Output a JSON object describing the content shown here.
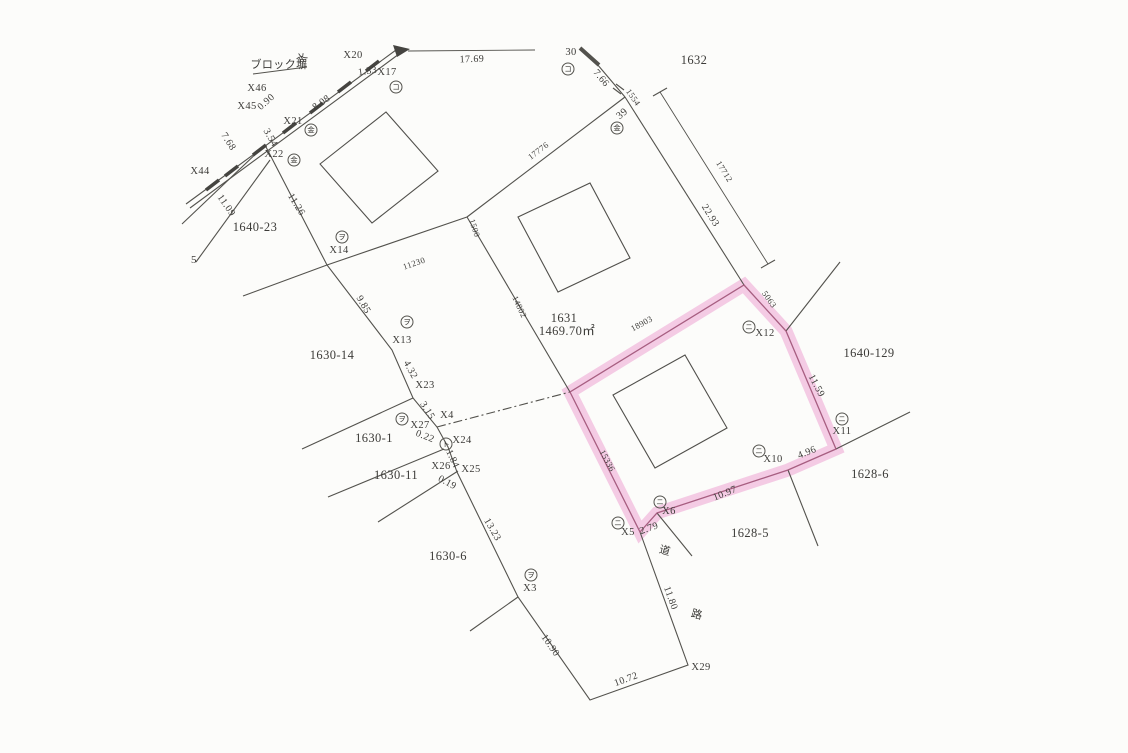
{
  "map": {
    "type": "cadastral-survey-map",
    "colors": {
      "paper": "#fcfcfa",
      "ink": "#3c3b38",
      "line": "#53524d",
      "red": "#c04a5e",
      "pink_band": "#eda2d2",
      "pink_edge": "#9e5276"
    },
    "highlighted_parcel": {
      "adjacent_note": "parcel outlined in pink between 1631 and 1628-5",
      "edge_lengths_mm": [
        "18903",
        "5063",
        "15336"
      ],
      "edge_lengths_m": [
        "11.59",
        "4.96",
        "10.97",
        "2.79"
      ]
    },
    "parcel_labels": [
      {
        "text": "1632",
        "x": 694,
        "y": 64,
        "size": 13
      },
      {
        "text": "1640-23",
        "x": 255,
        "y": 231
      },
      {
        "text": "1630-14",
        "x": 332,
        "y": 359
      },
      {
        "text": "1630-1",
        "x": 374,
        "y": 442
      },
      {
        "text": "1630-11",
        "x": 396,
        "y": 479
      },
      {
        "text": "1630-6",
        "x": 448,
        "y": 560
      },
      {
        "text": "1628-5",
        "x": 750,
        "y": 537
      },
      {
        "text": "1628-6",
        "x": 870,
        "y": 478
      },
      {
        "text": "1640-129",
        "x": 869,
        "y": 357
      },
      {
        "text": "1631",
        "x": 564,
        "y": 322,
        "size": 13
      },
      {
        "text": "1469.70㎡",
        "x": 567,
        "y": 335,
        "size": 10.5
      }
    ],
    "point_labels": [
      {
        "text": "X46",
        "x": 257,
        "y": 91
      },
      {
        "text": "X45",
        "x": 247,
        "y": 109
      },
      {
        "text": "X44",
        "x": 200,
        "y": 174
      },
      {
        "text": "X20",
        "x": 353,
        "y": 58
      },
      {
        "text": "X17",
        "x": 387,
        "y": 75
      },
      {
        "text": "X21",
        "x": 293,
        "y": 124
      },
      {
        "text": "X22",
        "x": 274,
        "y": 157
      },
      {
        "text": "X14",
        "x": 339,
        "y": 253
      },
      {
        "text": "X13",
        "x": 402,
        "y": 343
      },
      {
        "text": "X23",
        "x": 425,
        "y": 388
      },
      {
        "text": "X4",
        "x": 447,
        "y": 418
      },
      {
        "text": "X27",
        "x": 420,
        "y": 428
      },
      {
        "text": "X24",
        "x": 462,
        "y": 443
      },
      {
        "text": "X26",
        "x": 441,
        "y": 469
      },
      {
        "text": "X25",
        "x": 471,
        "y": 472
      },
      {
        "text": "X3",
        "x": 530,
        "y": 591
      },
      {
        "text": "X29",
        "x": 701,
        "y": 670
      },
      {
        "text": "X5",
        "x": 628,
        "y": 535
      },
      {
        "text": "X6",
        "x": 669,
        "y": 514,
        "color": "red"
      },
      {
        "text": "X10",
        "x": 773,
        "y": 462,
        "color": "red"
      },
      {
        "text": "X11",
        "x": 842,
        "y": 434
      },
      {
        "text": "X12",
        "x": 765,
        "y": 336,
        "color": "red"
      },
      {
        "text": "30",
        "x": 571,
        "y": 55
      },
      {
        "text": "39",
        "x": 624,
        "y": 116,
        "rot": -40
      }
    ],
    "measurements": [
      {
        "text": "17.69",
        "x": 472,
        "y": 62,
        "rot": -2
      },
      {
        "text": "1.33",
        "x": 368,
        "y": 74,
        "rot": -8
      },
      {
        "text": "0.90",
        "x": 268,
        "y": 104,
        "rot": -42
      },
      {
        "text": "8.08",
        "x": 323,
        "y": 105,
        "rot": -35
      },
      {
        "text": "7.68",
        "x": 226,
        "y": 143,
        "rot": 58
      },
      {
        "text": "3.54",
        "x": 268,
        "y": 139,
        "rot": 60
      },
      {
        "text": "11.09",
        "x": 224,
        "y": 207,
        "rot": 55
      },
      {
        "text": "11.26",
        "x": 294,
        "y": 206,
        "rot": 58
      },
      {
        "text": "9.85",
        "x": 361,
        "y": 306,
        "rot": 60
      },
      {
        "text": "4.32",
        "x": 408,
        "y": 371,
        "rot": 62
      },
      {
        "text": "3.15",
        "x": 425,
        "y": 412,
        "rot": 58
      },
      {
        "text": "0.22",
        "x": 424,
        "y": 439,
        "rot": 22
      },
      {
        "text": "1.84",
        "x": 450,
        "y": 460,
        "rot": 65
      },
      {
        "text": "0.19",
        "x": 446,
        "y": 485,
        "rot": 28
      },
      {
        "text": "13.23",
        "x": 490,
        "y": 531,
        "rot": 60
      },
      {
        "text": "10.90",
        "x": 548,
        "y": 647,
        "rot": 55
      },
      {
        "text": "10.72",
        "x": 627,
        "y": 682,
        "rot": -20
      },
      {
        "text": "11.80",
        "x": 668,
        "y": 599,
        "rot": 70
      },
      {
        "text": "7.66",
        "x": 599,
        "y": 80,
        "rot": 50
      },
      {
        "text": "22.93",
        "x": 708,
        "y": 217,
        "rot": 58
      },
      {
        "text": "11.59",
        "x": 814,
        "y": 387,
        "rot": 62
      },
      {
        "text": "4.96",
        "x": 808,
        "y": 455,
        "rot": -22,
        "color": "red"
      },
      {
        "text": "10.97",
        "x": 726,
        "y": 496,
        "rot": -22,
        "color": "red"
      },
      {
        "text": "2.79",
        "x": 650,
        "y": 531,
        "rot": -20,
        "color": "red"
      }
    ],
    "mm_values": [
      {
        "text": "17776",
        "x": 540,
        "y": 153,
        "rot": -37
      },
      {
        "text": "1500",
        "x": 472,
        "y": 229,
        "rot": 72
      },
      {
        "text": "14802",
        "x": 517,
        "y": 308,
        "rot": 65
      },
      {
        "text": "11230",
        "x": 415,
        "y": 266,
        "rot": -19
      },
      {
        "text": "1554",
        "x": 631,
        "y": 99,
        "rot": 55
      },
      {
        "text": "17712",
        "x": 722,
        "y": 173,
        "rot": 58
      },
      {
        "text": "5063",
        "x": 767,
        "y": 301,
        "rot": 55
      },
      {
        "text": "18903",
        "x": 643,
        "y": 326,
        "rot": -28
      },
      {
        "text": "15336",
        "x": 605,
        "y": 462,
        "rot": 62
      }
    ],
    "annotations": [
      {
        "text": "ブロック塀",
        "x": 279,
        "y": 68,
        "size": 11
      },
      {
        "text": "水",
        "x": 304,
        "y": 61,
        "rot": -35,
        "size": 13
      },
      {
        "text": "道",
        "x": 664,
        "y": 554,
        "rot": 15,
        "size": 13
      },
      {
        "text": "路",
        "x": 696,
        "y": 618,
        "rot": 15,
        "size": 13
      },
      {
        "text": "5",
        "x": 194,
        "y": 263,
        "size": 10
      }
    ],
    "markers": [
      {
        "glyph": "コ",
        "x": 396,
        "y": 87
      },
      {
        "glyph": "コ",
        "x": 568,
        "y": 69
      },
      {
        "glyph": "金",
        "x": 617,
        "y": 128
      },
      {
        "glyph": "金",
        "x": 311,
        "y": 130
      },
      {
        "glyph": "金",
        "x": 294,
        "y": 160
      },
      {
        "glyph": "ヲ",
        "x": 342,
        "y": 237
      },
      {
        "glyph": "ヲ",
        "x": 407,
        "y": 322
      },
      {
        "glyph": "ヲ",
        "x": 402,
        "y": 419
      },
      {
        "glyph": "ト",
        "x": 446,
        "y": 444
      },
      {
        "glyph": "ヲ",
        "x": 531,
        "y": 575
      },
      {
        "glyph": "ニ",
        "x": 749,
        "y": 327
      },
      {
        "glyph": "ニ",
        "x": 842,
        "y": 419
      },
      {
        "glyph": "ニ",
        "x": 759,
        "y": 451
      },
      {
        "glyph": "ニ",
        "x": 660,
        "y": 502
      },
      {
        "glyph": "ニ",
        "x": 618,
        "y": 523
      }
    ]
  }
}
